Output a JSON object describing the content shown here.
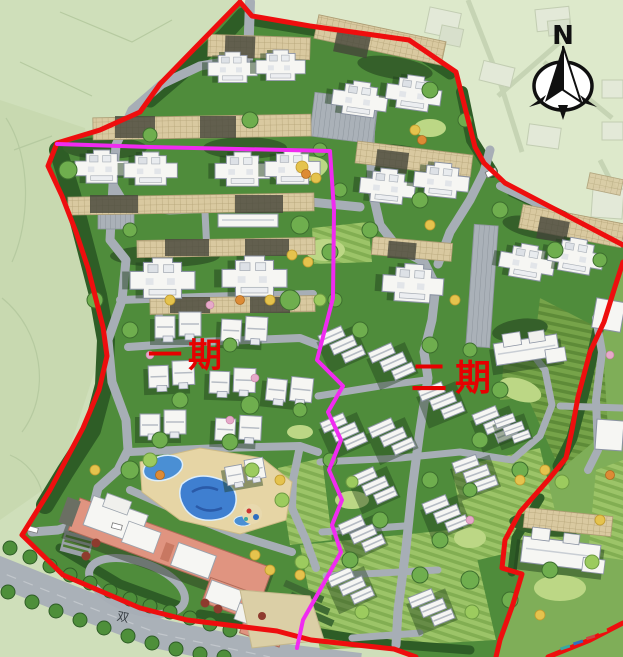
{
  "map": {
    "labels": {
      "phase1": "一期",
      "phase2": "二期",
      "compass_north": "N",
      "road_name": "双"
    },
    "colors": {
      "phase_boundary": "#ee0e0e",
      "phase_divider": "#f02bf0",
      "phase_label": "#e60000",
      "site_green": "#4f8c3b",
      "outside_green": "#cfdfba",
      "outside_light": "#dde9cb",
      "road_gray": "#a7aeb6",
      "water_blue": "#3f7fd0",
      "building_white": "#f6f6f3",
      "podium_tan": "#d9c9a0",
      "clubhouse_salmon": "#e09480",
      "tree_dark": "#2e5d26"
    }
  }
}
